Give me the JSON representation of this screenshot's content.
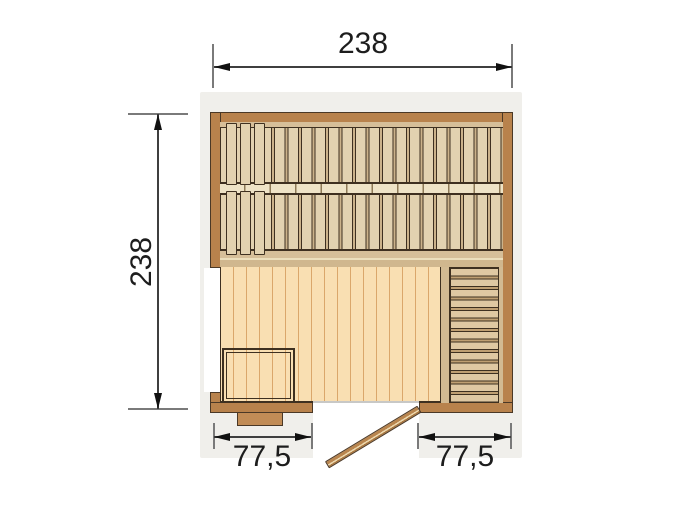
{
  "diagram": {
    "type": "sauna-floor-plan-top-view",
    "dimensions": {
      "top": "238",
      "left": "238",
      "bottom_left": "77,5",
      "bottom_right": "77,5"
    },
    "colors": {
      "wall": "#b8824c",
      "outline": "#3e3020",
      "bench_slat": "#e2d2b0",
      "bench_background": "#cbb28a",
      "floor": "#f9dfb2",
      "floor_line": "#daa76b",
      "backdrop": "#f0efeb",
      "door": "#b9854e",
      "dimension_text": "#1d1d1d"
    }
  }
}
